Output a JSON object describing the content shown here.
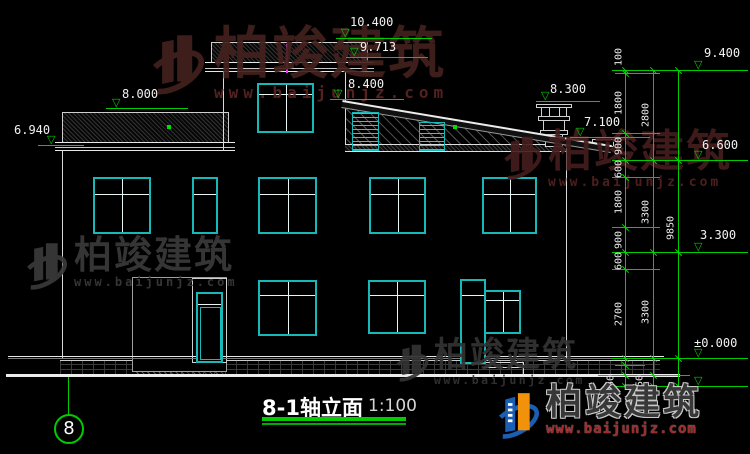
{
  "watermark": {
    "brand": "柏竣建筑",
    "url": "www.baijunjz.com"
  },
  "footer_logo": {
    "brand": "柏竣建筑",
    "url": "www.baijunjz.com"
  },
  "title": {
    "name": "8-1轴立面",
    "scale": "1:100"
  },
  "axis": {
    "label": "8"
  },
  "elevations": {
    "top_tower": "10.400",
    "tower_slab": "9.713",
    "slope_high": "8.400",
    "chimney": "8.300",
    "left_roof": "8.000",
    "slope_low": "7.100",
    "left_eave": "6.940",
    "right_top": "9.400",
    "right_eave": "6.600",
    "second_floor": "3.300",
    "ground": "±0.000"
  },
  "dims": {
    "inner": {
      "s1": "100",
      "s2": "1800",
      "s3": "900",
      "s4": "600",
      "s5": "1800",
      "s6": "900",
      "s7": "600",
      "s8": "2700",
      "s9": "150"
    },
    "middle": {
      "s1": "2800",
      "s2": "3300",
      "s3": "3300",
      "s4": "450"
    },
    "total": "9850"
  },
  "colors": {
    "dim_green": "#00cc00",
    "window_cyan": "#16b8b8",
    "marker_magenta": "#e33ee3",
    "watermark_red": "#4a1d1d",
    "watermark_gray": "#3a3a3a",
    "logo_blue": "#1a5fb4",
    "logo_orange": "#f2920a"
  }
}
